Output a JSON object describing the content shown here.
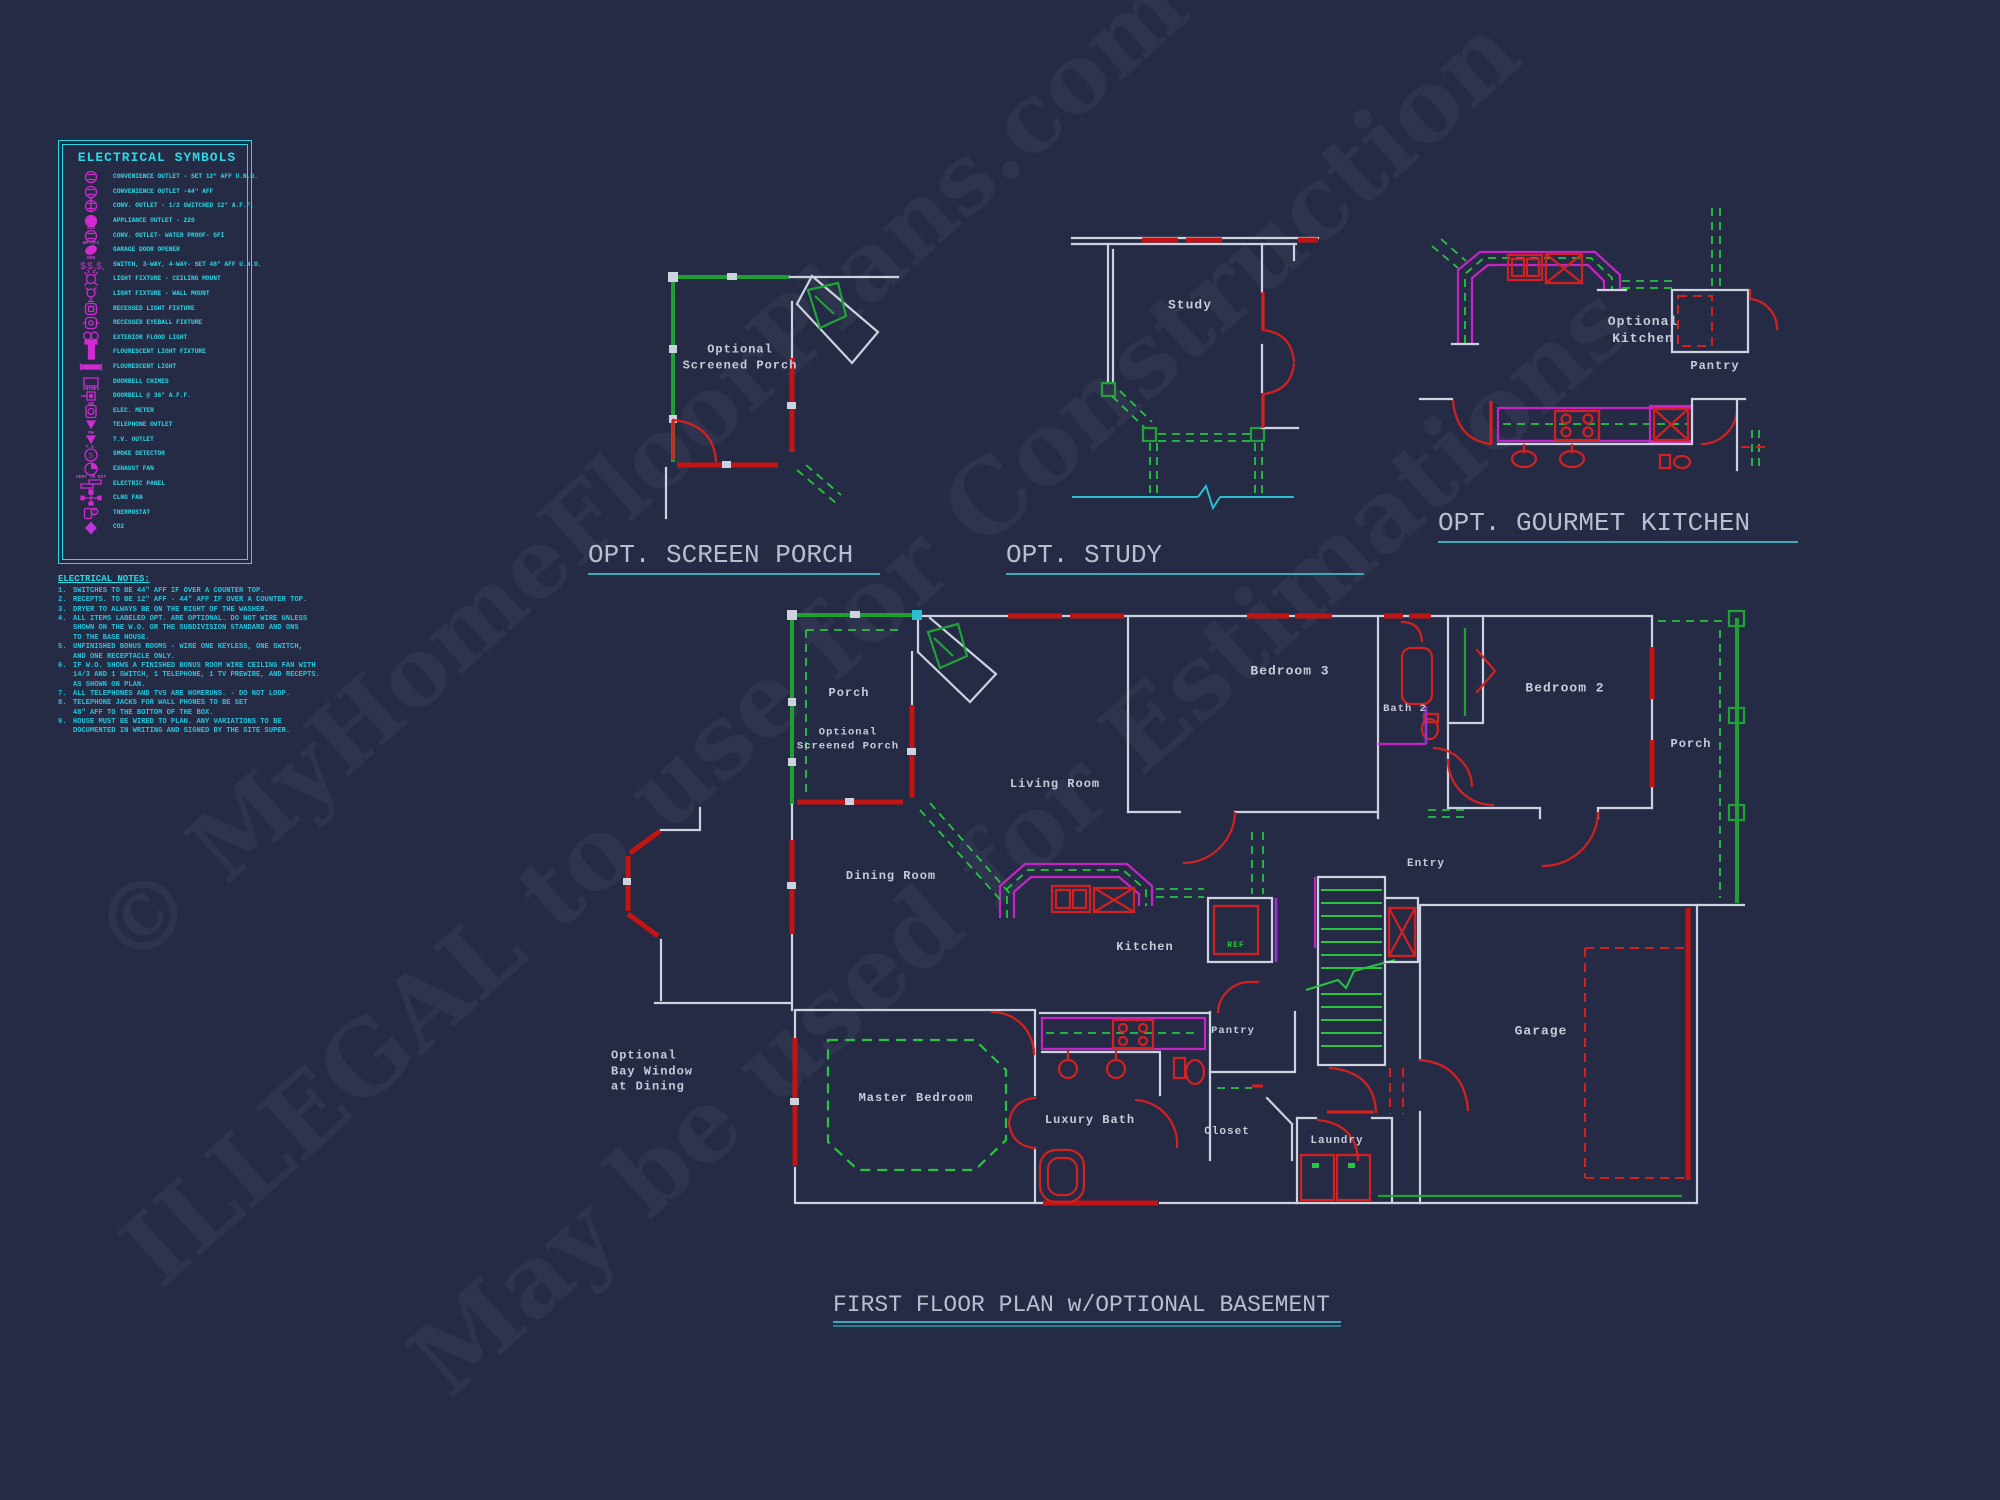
{
  "page": {
    "background": "#262b45",
    "accent_cyan": "#2bd8e6",
    "accent_magenta": "#c724c7",
    "wall_white": "#ccd2df",
    "wall_red": "#c31414",
    "wall_green": "#1e9e33",
    "underline_teal": "#3fa9bc"
  },
  "watermark": {
    "lines": [
      "© MyHomeFloorPlans.com",
      "ILLEGAL to use for Construction",
      "May be used for Estimations"
    ]
  },
  "legend": {
    "title": "ELECTRICAL SYMBOLS",
    "items": [
      {
        "glyph": "outlet-duplex",
        "sub": "",
        "label": "CONVENIENCE OUTLET - SET 12\" AFF U.N.O."
      },
      {
        "glyph": "outlet-duplex",
        "sub": "A",
        "label": "CONVENIENCE OUTLET -44\" AFF"
      },
      {
        "glyph": "outlet-half",
        "sub": "",
        "label": "CONV. OUTLET - 1/2 SWITCHED 12\" A.F.F."
      },
      {
        "glyph": "outlet-filled",
        "sub": "220",
        "label": "APPLIANCE OUTLET - 220"
      },
      {
        "glyph": "outlet-duplex",
        "sub": "WP/GFI",
        "label": "CONV. OUTLET- WATER PROOF- GFI"
      },
      {
        "glyph": "outlet-gdo",
        "sub": "GDO",
        "label": "GARAGE DOOR OPENER"
      },
      {
        "glyph": "switches",
        "sub": "3   4",
        "label": "SWITCH, 3-WAY, 4-WAY- SET 48\" AFF U.N.O."
      },
      {
        "glyph": "light-ceiling",
        "sub": "",
        "label": "LIGHT FIXTURE - CEILING MOUNT"
      },
      {
        "glyph": "light-wall",
        "sub": "",
        "label": "LIGHT FIXTURE - WALL MOUNT"
      },
      {
        "glyph": "recessed",
        "sub": "",
        "label": "RECESSED LIGHT FIXTURE"
      },
      {
        "glyph": "eyeball",
        "sub": "",
        "label": "RECESSED EYEBALL FIXTURE"
      },
      {
        "glyph": "flood",
        "sub": "",
        "label": "EXTERIOR FLOOD LIGHT"
      },
      {
        "glyph": "fluor-vert",
        "sub": "",
        "label": "FLOURESCENT LIGHT FIXTURE"
      },
      {
        "glyph": "fluor-horiz",
        "sub": "",
        "label": "FLOURESCENT LIGHT"
      },
      {
        "glyph": "chimes",
        "sub": "CHIMES",
        "label": "DOORBELL CHIMES"
      },
      {
        "glyph": "doorbell",
        "sub": "DB",
        "label": "DOORBELL @ 36\" A.F.F."
      },
      {
        "glyph": "meter",
        "sub": "",
        "label": "ELEC. METER"
      },
      {
        "glyph": "tel",
        "sub": "PH",
        "label": "TELEPHONE OUTLET"
      },
      {
        "glyph": "tv",
        "sub": "T.V.",
        "label": "T.V. OUTLET"
      },
      {
        "glyph": "smoke",
        "sub": "",
        "label": "SMOKE DETECTOR"
      },
      {
        "glyph": "fan",
        "sub": "VENT TO EXT",
        "label": "EXHAUST FAN"
      },
      {
        "glyph": "panel",
        "sub": "EP",
        "label": "ELECTRIC PANEL"
      },
      {
        "glyph": "ceiling-fan",
        "sub": "",
        "label": "CLNG FAN"
      },
      {
        "glyph": "thermostat",
        "sub": "",
        "label": "THERMOSTAT"
      },
      {
        "glyph": "co2",
        "sub": "",
        "label": "CO2"
      }
    ]
  },
  "notes": {
    "title": "ELECTRICAL NOTES:",
    "items": [
      "SWITCHES TO BE 44\" AFF IF OVER A COUNTER TOP.",
      "RECEPTS. TO BE 12\" AFF - 44\" AFF IF OVER A COUNTER TOP.",
      "DRYER TO ALWAYS BE ON THE RIGHT OF THE WASHER.",
      "ALL ITEMS LABELED OPT. ARE OPTIONAL.  DO NOT WIRE UNLESS\nSHOWN ON THE W.O. OR THE SUBDIVISION STANDARD AND ONS\nTO THE BASE HOUSE.",
      "UNFINISHED BONUS ROOMS - WIRE ONE KEYLESS, ONE SWITCH,\nAND ONE RECEPTACLE ONLY.",
      "IF W.O. SHOWS A FINISHED BONUS ROOM WIRE CEILING FAN WITH\n14/3 AND 1 SWITCH, 1 TELEPHONE, 1 TV PREWIRE, AND RECEPTS.\nAS SHOWN ON PLAN.",
      "ALL TELEPHONES AND TVS ARE HOMERUNS. - DO NOT LOOP.",
      "TELEPHONE JACKS FOR WALL PHONES TO BE SET\n48\" AFF TO THE BOTTOM OF THE BOX.",
      "HOUSE MUST BE WIRED TO PLAN.  ANY VARIATIONS TO BE\nDOCUMENTED IN WRITING AND SIGNED BY THE SITE SUPER."
    ]
  },
  "titles": [
    {
      "text": "OPT. SCREEN PORCH",
      "x": 588,
      "y": 540,
      "w": 292,
      "fs": 26,
      "u": "single"
    },
    {
      "text": "OPT. STUDY",
      "x": 1006,
      "y": 540,
      "w": 358,
      "fs": 26,
      "u": "single"
    },
    {
      "text": "OPT. GOURMET KITCHEN",
      "x": 1438,
      "y": 508,
      "w": 360,
      "fs": 26,
      "u": "single"
    },
    {
      "text": "FIRST FLOOR PLAN w/OPTIONAL BASEMENT",
      "x": 833,
      "y": 1292,
      "w": 508,
      "fs": 23,
      "u": "double"
    }
  ],
  "labels": [
    {
      "t": "Optional\nScreened Porch",
      "x": 740,
      "y": 358,
      "fs": 12
    },
    {
      "t": "Study",
      "x": 1190,
      "y": 306,
      "fs": 13
    },
    {
      "t": "Optional\nKitchen",
      "x": 1643,
      "y": 331,
      "fs": 13
    },
    {
      "t": "Pantry",
      "x": 1715,
      "y": 367,
      "fs": 12
    },
    {
      "t": "Porch",
      "x": 849,
      "y": 694,
      "fs": 12
    },
    {
      "t": "Optional\nScreened Porch",
      "x": 848,
      "y": 740,
      "fs": 10.5
    },
    {
      "t": "Living Room",
      "x": 1055,
      "y": 785,
      "fs": 12
    },
    {
      "t": "Bedroom 3",
      "x": 1290,
      "y": 672,
      "fs": 13
    },
    {
      "t": "Bath 2",
      "x": 1405,
      "y": 710,
      "fs": 10.5
    },
    {
      "t": "Bedroom 2",
      "x": 1565,
      "y": 689,
      "fs": 13
    },
    {
      "t": "Porch",
      "x": 1691,
      "y": 745,
      "fs": 12
    },
    {
      "t": "Entry",
      "x": 1426,
      "y": 864,
      "fs": 11
    },
    {
      "t": "Dining Room",
      "x": 891,
      "y": 877,
      "fs": 12
    },
    {
      "t": "Kitchen",
      "x": 1145,
      "y": 948,
      "fs": 12
    },
    {
      "t": "REF",
      "x": 1236,
      "y": 946,
      "fs": 8,
      "c": "#27c440"
    },
    {
      "t": "Pantry",
      "x": 1233,
      "y": 1032,
      "fs": 10.5
    },
    {
      "t": "Master Bedroom",
      "x": 916,
      "y": 1099,
      "fs": 12
    },
    {
      "t": "Luxury Bath",
      "x": 1090,
      "y": 1121,
      "fs": 12
    },
    {
      "t": "Closet",
      "x": 1227,
      "y": 1132,
      "fs": 11
    },
    {
      "t": "Laundry",
      "x": 1337,
      "y": 1141,
      "fs": 11
    },
    {
      "t": "Garage",
      "x": 1541,
      "y": 1032,
      "fs": 13
    },
    {
      "t": "Optional\nBay Window\nat Dining",
      "x": 611,
      "y": 1072,
      "fs": 12,
      "a": "l"
    }
  ]
}
